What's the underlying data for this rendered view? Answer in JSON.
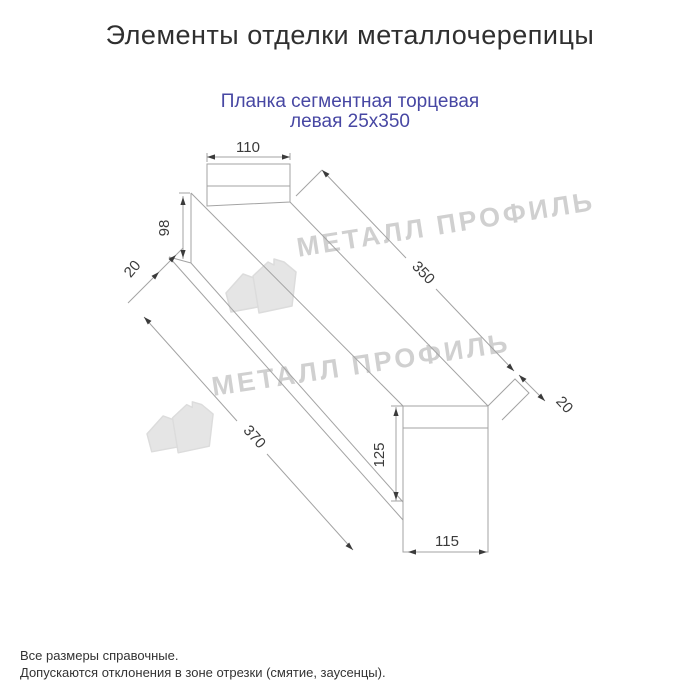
{
  "header": {
    "title": "Элементы отделки металлочерепицы"
  },
  "product": {
    "subtitle_line1": "Планка сегментная торцевая",
    "subtitle_line2": "левая 25х350"
  },
  "drawing": {
    "description": "technical outline drawing of left segmental end strip 25x350",
    "dimensions": {
      "top_width": "110",
      "left_height": "98",
      "left_fold": "20",
      "edge_top": "350",
      "edge_bottom": "370",
      "right_fold": "20",
      "right_height": "125",
      "bottom_width": "115"
    }
  },
  "watermark": {
    "text": "МЕТАЛЛ ПРОФИЛЬ"
  },
  "footnotes": {
    "line1": "Все размеры справочные.",
    "line2": "Допускаются отклонения в зоне отрезки (смятие, заусенцы)."
  },
  "colors": {
    "background": "#ffffff",
    "title_text": "#2f2f2f",
    "subtitle_text": "#4747a3",
    "drawing_lines": "#a3a3a3",
    "dimension_text": "#3b3b3b",
    "watermark": "#d9d9d9"
  }
}
